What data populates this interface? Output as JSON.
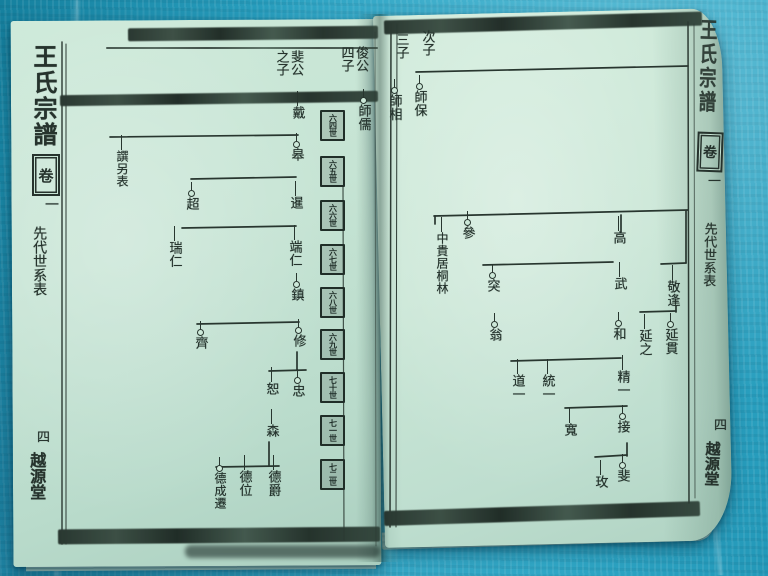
{
  "book": {
    "title": "王氏宗譜",
    "volume_char": "卷",
    "volume_number": "一",
    "section_label": "先代世系表",
    "page_number": "四",
    "hall_name": "越源堂"
  },
  "left_page": {
    "headers": [
      {
        "text": "斐公之子"
      },
      {
        "text": "俊公四子"
      }
    ],
    "generation_labels": [
      "六四世",
      "六五世",
      "六六世",
      "六七世",
      "六八世",
      "六九世",
      "七十世",
      "七一世",
      "七二世"
    ],
    "nodes": [
      {
        "name": "師儒",
        "x": 357,
        "y": 104,
        "circle": true
      },
      {
        "name": "戴",
        "x": 291,
        "y": 106,
        "circle": false
      },
      {
        "name": "皋",
        "x": 290,
        "y": 148,
        "circle": true
      },
      {
        "name": "暹",
        "x": 289,
        "y": 196,
        "circle": false
      },
      {
        "name": "端仁",
        "x": 288,
        "y": 240,
        "circle": false
      },
      {
        "name": "鎮",
        "x": 290,
        "y": 288,
        "circle": true
      },
      {
        "name": "修",
        "x": 292,
        "y": 334,
        "circle": true
      },
      {
        "name": "忠",
        "x": 291,
        "y": 384,
        "circle": true
      },
      {
        "name": "恕",
        "x": 265,
        "y": 382,
        "circle": false
      },
      {
        "name": "森",
        "x": 265,
        "y": 424,
        "circle": false
      },
      {
        "name": "德爵",
        "x": 267,
        "y": 470,
        "circle": false
      },
      {
        "name": "德位",
        "x": 238,
        "y": 470,
        "circle": false
      },
      {
        "name": "德成遷",
        "x": 213,
        "y": 472,
        "circle": true
      },
      {
        "name": "譔另表",
        "x": 115,
        "y": 150,
        "circle": false
      },
      {
        "name": "超",
        "x": 185,
        "y": 197,
        "circle": true
      },
      {
        "name": "瑞仁",
        "x": 168,
        "y": 241,
        "circle": false
      },
      {
        "name": "齊",
        "x": 194,
        "y": 336,
        "circle": true
      }
    ]
  },
  "right_page": {
    "headers": [
      {
        "text": "次子"
      },
      {
        "text": "三子"
      }
    ],
    "nodes": [
      {
        "name": "師保",
        "x": 413,
        "y": 90,
        "circle": true
      },
      {
        "name": "師相",
        "x": 388,
        "y": 94,
        "circle": true
      },
      {
        "name": "參",
        "x": 461,
        "y": 226,
        "circle": true
      },
      {
        "name": "中貴居桐林",
        "x": 435,
        "y": 232,
        "circle": false
      },
      {
        "name": "高",
        "x": 612,
        "y": 231,
        "circle": false
      },
      {
        "name": "武",
        "x": 613,
        "y": 277,
        "circle": false
      },
      {
        "name": "和",
        "x": 612,
        "y": 327,
        "circle": true
      },
      {
        "name": "精一",
        "x": 616,
        "y": 370,
        "circle": false
      },
      {
        "name": "突",
        "x": 486,
        "y": 279,
        "circle": true
      },
      {
        "name": "翁",
        "x": 488,
        "y": 328,
        "circle": true
      },
      {
        "name": "敬逢",
        "x": 666,
        "y": 280,
        "circle": false
      },
      {
        "name": "延貫",
        "x": 664,
        "y": 328,
        "circle": true
      },
      {
        "name": "延之",
        "x": 638,
        "y": 329,
        "circle": false
      },
      {
        "name": "道一",
        "x": 511,
        "y": 374,
        "circle": false
      },
      {
        "name": "統一",
        "x": 541,
        "y": 374,
        "circle": false
      },
      {
        "name": "接",
        "x": 616,
        "y": 420,
        "circle": true
      },
      {
        "name": "寬",
        "x": 563,
        "y": 423,
        "circle": false
      },
      {
        "name": "玫",
        "x": 594,
        "y": 475,
        "circle": false
      },
      {
        "name": "斐",
        "x": 616,
        "y": 469,
        "circle": true
      }
    ]
  }
}
